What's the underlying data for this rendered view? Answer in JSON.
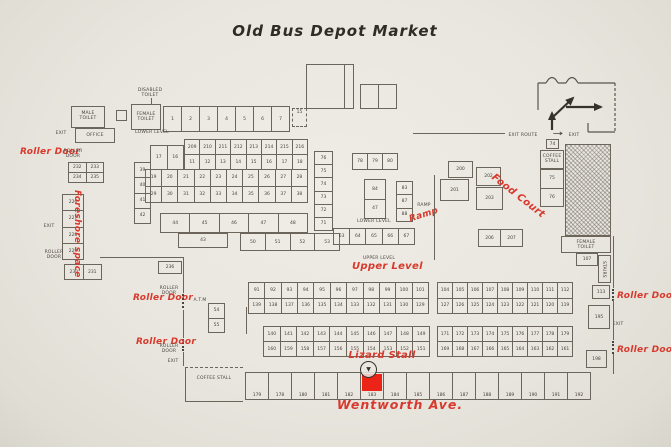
{
  "title": "Old Bus Depot Market",
  "colors": {
    "red": "#d8392c",
    "ink": "#49443d",
    "paper": "#e9e6df",
    "highlight": "#ec2418"
  },
  "annotations": {
    "roller_door": "Roller Door",
    "foreshore": "Foreshore space",
    "food_court": "Food Court",
    "ramp": "Ramp",
    "upper_level": "Upper Level",
    "lizard_stall": "Lizard Stall",
    "wentworth": "Wentworth Ave."
  },
  "labels": {
    "male_toilet": "MALE TOILET",
    "disabled_toilet": "DISABLED TOILET",
    "female_toilet": "FEMALE TOILET",
    "office": "OFFICE",
    "exit": "EXIT",
    "lower_level": "LOWER LEVEL",
    "upper_level": "UPPER LEVEL",
    "ramp": "RAMP",
    "atm": "A.T.M",
    "roller_door": "ROLLER DOOR",
    "coffee_stall": "COFFEE STALL",
    "stairs": "STAIRS",
    "exit_route": "EXIT ROUTE",
    "route_arrow": "→",
    "marker_arrow": "▼"
  },
  "stalls": {
    "rowA": [
      "1",
      "2",
      "3",
      "4",
      "5",
      "6",
      "7"
    ],
    "dashed_box": "15",
    "rowB_lead": [
      "17",
      "16"
    ],
    "rowB": [
      {
        "t": "209",
        "b": "11"
      },
      {
        "t": "210",
        "b": "12"
      },
      {
        "t": "211",
        "b": "13"
      },
      {
        "t": "212",
        "b": "14"
      },
      {
        "t": "213",
        "b": "15"
      },
      {
        "t": "214",
        "b": "16"
      },
      {
        "t": "215",
        "b": "17"
      },
      {
        "t": "216",
        "b": "18"
      }
    ],
    "rowC": [
      {
        "t": "19",
        "b": "29"
      },
      {
        "t": "20",
        "b": "30"
      },
      {
        "t": "21",
        "b": "31"
      },
      {
        "t": "22",
        "b": "32"
      },
      {
        "t": "23",
        "b": "33"
      },
      {
        "t": "24",
        "b": "34"
      },
      {
        "t": "25",
        "b": "35"
      },
      {
        "t": "26",
        "b": "36"
      },
      {
        "t": "27",
        "b": "37"
      },
      {
        "t": "28",
        "b": "38"
      }
    ],
    "blockTL1": [
      "232",
      "233"
    ],
    "blockTL2": [
      "234",
      "235"
    ],
    "colTL": [
      "226",
      "227",
      "228",
      "229"
    ],
    "rowTL3": [
      "230",
      "231"
    ],
    "colLeft": [
      "39",
      "40",
      "41",
      "42"
    ],
    "rowML1": [
      "44",
      "45",
      "46",
      "47",
      "48"
    ],
    "boxML": "43",
    "rowML2": [
      "50",
      "51",
      "52",
      "53"
    ],
    "cell236": "236",
    "colATM": [
      "54",
      "55"
    ],
    "colCenter": [
      "76",
      "75",
      "74",
      "73",
      "72",
      "71"
    ],
    "rowCenterTop": [
      "78",
      "79",
      "80"
    ],
    "blockCenter": [
      "84",
      "47"
    ],
    "colCenterR": [
      "83",
      "87",
      "88"
    ],
    "rowCenterBottom": [
      "63",
      "64",
      "65",
      "66",
      "67"
    ],
    "band1L": [
      {
        "t": "91",
        "b": "139"
      },
      {
        "t": "92",
        "b": "138"
      },
      {
        "t": "93",
        "b": "137"
      },
      {
        "t": "94",
        "b": "136"
      },
      {
        "t": "95",
        "b": "135"
      },
      {
        "t": "96",
        "b": "134"
      },
      {
        "t": "97",
        "b": "133"
      },
      {
        "t": "98",
        "b": "132"
      },
      {
        "t": "99",
        "b": "131"
      },
      {
        "t": "100",
        "b": "130"
      },
      {
        "t": "101",
        "b": "129"
      }
    ],
    "band1R": [
      {
        "t": "104",
        "b": "127"
      },
      {
        "t": "105",
        "b": "126"
      },
      {
        "t": "106",
        "b": "125"
      },
      {
        "t": "107",
        "b": "124"
      },
      {
        "t": "108",
        "b": "123"
      },
      {
        "t": "109",
        "b": "122"
      },
      {
        "t": "110",
        "b": "121"
      },
      {
        "t": "111",
        "b": "120"
      },
      {
        "t": "112",
        "b": "119"
      }
    ],
    "band2L": [
      {
        "t": "140",
        "b": "160"
      },
      {
        "t": "141",
        "b": "159"
      },
      {
        "t": "142",
        "b": "158"
      },
      {
        "t": "143",
        "b": "157"
      },
      {
        "t": "144",
        "b": "156"
      },
      {
        "t": "145",
        "b": "155"
      },
      {
        "t": "146",
        "b": "154"
      },
      {
        "t": "147",
        "b": "153"
      },
      {
        "t": "148",
        "b": "152"
      },
      {
        "t": "149",
        "b": "151"
      }
    ],
    "band2R": [
      {
        "t": "171",
        "b": "169"
      },
      {
        "t": "172",
        "b": "168"
      },
      {
        "t": "173",
        "b": "167"
      },
      {
        "t": "174",
        "b": "166"
      },
      {
        "t": "175",
        "b": "165"
      },
      {
        "t": "176",
        "b": "164"
      },
      {
        "t": "177",
        "b": "163"
      },
      {
        "t": "178",
        "b": "162"
      },
      {
        "t": "179",
        "b": "161"
      }
    ],
    "fcA": "200",
    "fcB": "201",
    "fcC": "202",
    "fcD": "203",
    "rowFC": [
      "206",
      "207"
    ],
    "box74": "74",
    "colTR": [
      "75",
      "76"
    ],
    "box107": "107",
    "box113": "113",
    "box195": "195",
    "box198": "198",
    "bottomRow": [
      "179",
      "178",
      "180",
      "181",
      "182",
      {
        "n": "183",
        "highlight": true
      },
      "184",
      "185",
      "186",
      "187",
      "188",
      "189",
      "190",
      "191",
      "192"
    ]
  }
}
